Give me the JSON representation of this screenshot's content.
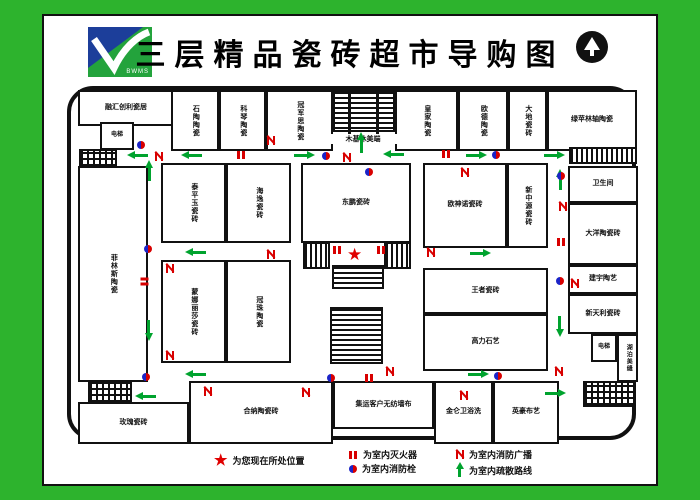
{
  "header": {
    "title": "三层精品瓷砖超市导购图",
    "logo_text": "BWMS"
  },
  "rooms": [
    {
      "label": "融汇创利瓷居"
    },
    {
      "label": "电梯"
    },
    {
      "label": "石陶陶瓷"
    },
    {
      "label": "科琴陶瓷"
    },
    {
      "label": "冠军思陶瓷"
    },
    {
      "label": "皇家陶瓷"
    },
    {
      "label": "欧德陶瓷"
    },
    {
      "label": "大地瓷砖"
    },
    {
      "label": "绿苹林轴陶瓷"
    },
    {
      "label": "木基休美端"
    },
    {
      "label": "菲林斯陶瓷"
    },
    {
      "label": "泰平玉瓷砖"
    },
    {
      "label": "海逸瓷砖"
    },
    {
      "label": "蒙娜丽莎瓷砖"
    },
    {
      "label": "冠珠陶瓷"
    },
    {
      "label": "东鹏瓷砖"
    },
    {
      "label": "欧神诺瓷砖"
    },
    {
      "label": "新中源瓷砖"
    },
    {
      "label": "王者瓷砖"
    },
    {
      "label": "高力石艺"
    },
    {
      "label": "卫生间"
    },
    {
      "label": "大洋陶瓷砖"
    },
    {
      "label": "建宇陶艺"
    },
    {
      "label": "新天利瓷砖"
    },
    {
      "label": "电梯"
    },
    {
      "label": "湖泊美缝"
    },
    {
      "label": "玫瑰瓷砖"
    },
    {
      "label": "合纳陶瓷砖"
    },
    {
      "label": "集运客户无纺墙布"
    },
    {
      "label": "金仑卫浴洗"
    },
    {
      "label": "英豪布艺"
    }
  ],
  "legend": {
    "star_symbol": "★",
    "you_are_here": "为您现在所处位置",
    "extinguisher": "为室内灭火器",
    "hydrant": "为室内消防栓",
    "broadcast": "为室内消防广播",
    "route": "为室内疏散路线"
  },
  "colors": {
    "frame_green": "#2db32d",
    "arrow_green": "#00a32e",
    "alert_red": "#d80000",
    "hydrant_blue": "#1c24c8"
  },
  "map_symbol": {
    "star": "★"
  }
}
